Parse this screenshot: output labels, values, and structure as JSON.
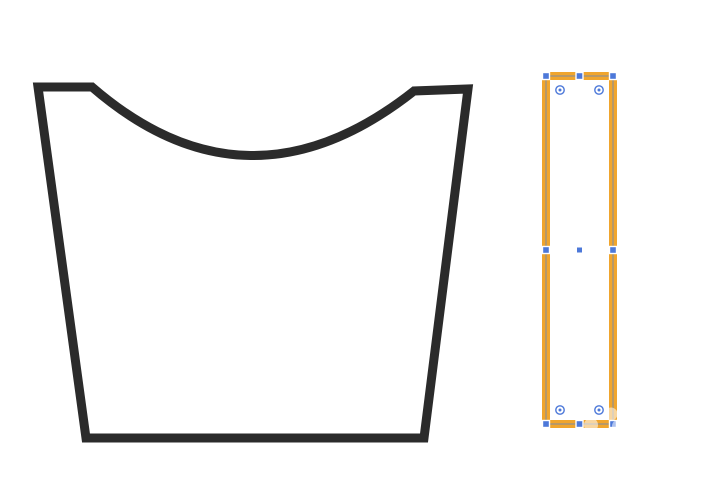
{
  "window": {
    "width": 715,
    "height": 488,
    "background": "#ffffff"
  },
  "colors": {
    "canvas-bg": "#ffffff",
    "basket-outline": "#2b2b2b",
    "basket-fill": "#ffffff",
    "selection-stroke": "#f0a52d",
    "selection-fill": "#ffffff",
    "bbox-gray": "#8f8f8f",
    "handle-blue": "#4c78d9",
    "handle-border": "#ffffff",
    "watermark": "#ffffff"
  },
  "scene": {
    "left_object": "bucket-outline-shape",
    "right_object": "selected-rectangle-orange-stroke",
    "selection_handles": 8,
    "corner_widgets": 4
  }
}
